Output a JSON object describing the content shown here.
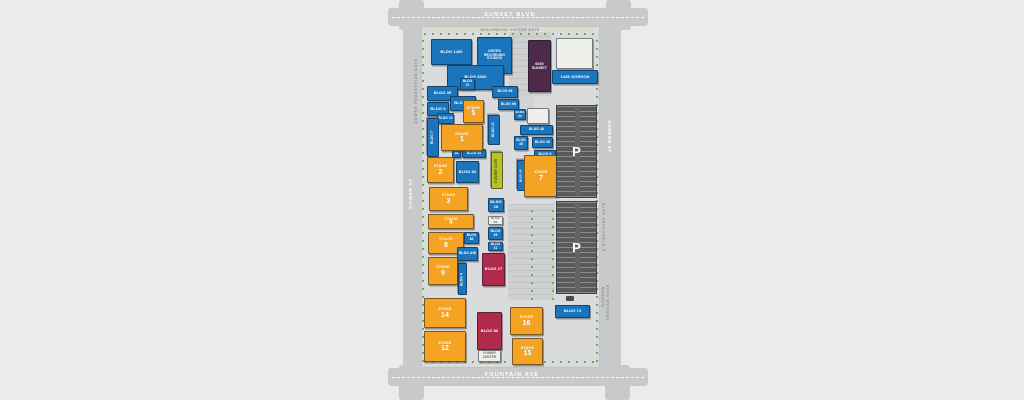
{
  "streets": {
    "top": "SUNSET BLVD",
    "bottom": "FOUNTAIN AVE",
    "left": "GOWER ST",
    "right": "GORDON ST"
  },
  "gates": {
    "beachwood": "BEACHWOOD VISITOR GATE",
    "gower_pedestrian": "GOWER PEDESTRIAN GATE",
    "e_structure": "E STRUCTURE GATE",
    "gordon": "GORDON",
    "gordon_service": "SERVICE GATE"
  },
  "stage_word": "STAGE",
  "stages": {
    "s1": "1",
    "s2": "2",
    "s3": "3",
    "s4": "4",
    "s5": "5",
    "s7": "7",
    "s8": "8",
    "s9": "9",
    "s12": "12",
    "s14": "14",
    "s15": "15",
    "s16": "16"
  },
  "buildings": {
    "b1460": "BLDG 1460",
    "united": "UNITED RECORDING STUDIOS",
    "b6060": "BLDG 6060",
    "b35": "BLDG 35",
    "b12": "BLDG 12",
    "b98a": "BLDG 98",
    "b96": "BLDG 96",
    "b9": "BLDG 9",
    "b93": "BLDG 93",
    "b10": "BLDG 10",
    "b7": "BLDG 7",
    "b11": "BLDG 11",
    "b3b": "3B",
    "b98b": "BLDG 98",
    "b82": "BLDG 82",
    "cafe": "GOWER CAFE",
    "b39": "BLDG 39",
    "b48": "BLDG 48",
    "b46": "BLDG 46",
    "b45": "BLDG 45",
    "b6": "BLDG 6",
    "b43": "BLDG 43",
    "b88": "BLDG 88",
    "bab": "BLDG A/B",
    "b4": "BLDG 4",
    "b28": "BLDG 28",
    "b5b": "BLDG 5B",
    "b29": "BLDG 29",
    "b31": "BLDG 31",
    "b27": "BLDG 27",
    "b86": "BLDG 86",
    "power": "POWER CENTER",
    "b74": "BLDG 74",
    "p6040": "6040 SUNSET",
    "g1435": "1435 GORDON"
  },
  "parking": {
    "p": "P"
  },
  "colors": {
    "blue": "#1b75bc",
    "orange": "#f5a323",
    "crimson": "#b02a4c",
    "purple": "#4d2a4a",
    "green_building": "#b8c226",
    "tree": "#76ad41",
    "street": "#c8c9ca",
    "lot": "#dadbdc"
  }
}
